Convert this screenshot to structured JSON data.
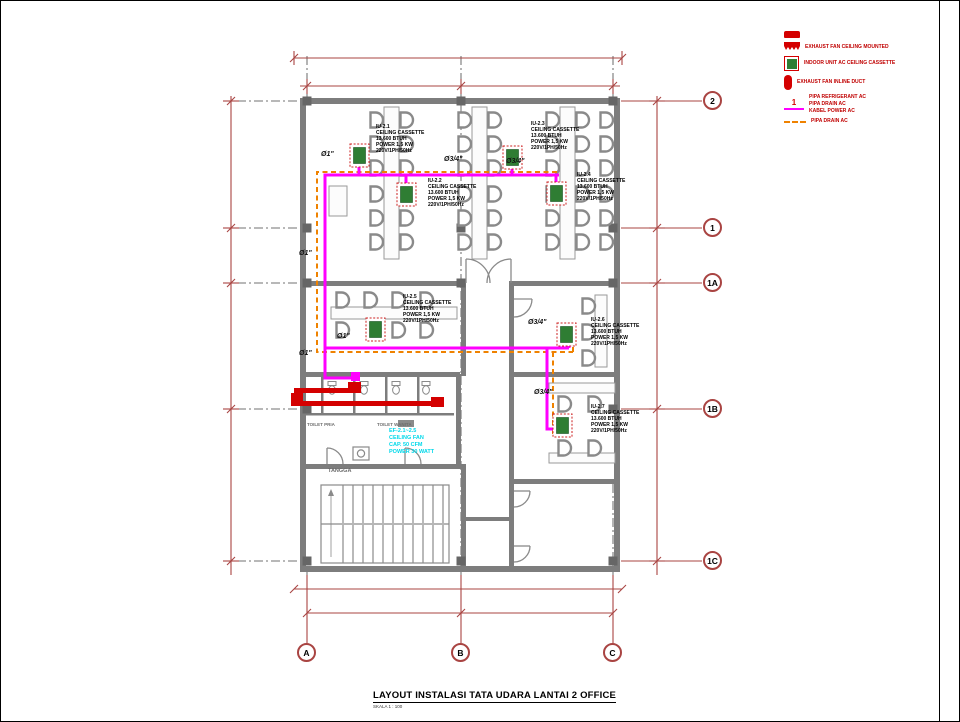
{
  "drawing_title": {
    "text": "LAYOUT INSTALASI TATA UDARA LANTAI 2 OFFICE",
    "scale": "SKALA 1 : 100"
  },
  "legend": {
    "items": [
      {
        "label": ""
      },
      {
        "label": "EXHAUST FAN CEILING MOUNTED"
      },
      {
        "label": "INDOOR UNIT AC CEILING CASSETTE"
      },
      {
        "label": "EXHAUST FAN INLINE DUCT"
      },
      {
        "label_lines": [
          "PIPA REFRIGERANT AC",
          "PIPA DRAIN AC",
          "KABEL POWER AC"
        ]
      },
      {
        "label": "PIPA DRAIN AC"
      }
    ]
  },
  "units": [
    {
      "tag": "IU-2.1",
      "type": "CEILING CASSETTE",
      "capacity": "13.600 BTUH",
      "power": "POWER 1,5 KW",
      "electrical": "220V/1PH/50Hz"
    },
    {
      "tag": "IU-2.2",
      "type": "CEILING CASSETTE",
      "capacity": "13.600 BTUH",
      "power": "POWER 1,5 KW",
      "electrical": "220V/1PH/50Hz"
    },
    {
      "tag": "IU-2.3",
      "type": "CEILING CASSETTE",
      "capacity": "13.600 BTUH",
      "power": "POWER 1,5 KW",
      "electrical": "220V/1PH/50Hz"
    },
    {
      "tag": "IU-2.4",
      "type": "CEILING CASSETTE",
      "capacity": "13.600 BTUH",
      "power": "POWER 1,5 KW",
      "electrical": "220V/1PH/50Hz"
    },
    {
      "tag": "IU-2.5",
      "type": "CEILING CASSETTE",
      "capacity": "13.600 BTUH",
      "power": "POWER 1,5 KW",
      "electrical": "220V/1PH/50Hz"
    },
    {
      "tag": "IU-2.6",
      "type": "CEILING CASSETTE",
      "capacity": "13.600 BTUH",
      "power": "POWER 1,5 KW",
      "electrical": "220V/1PH/50Hz"
    },
    {
      "tag": "IU-2.7",
      "type": "CEILING CASSETTE",
      "capacity": "13.600 BTUH",
      "power": "POWER 1,5 KW",
      "electrical": "220V/1PH/50Hz"
    }
  ],
  "exhaust_fan_label": {
    "tag": "EF-2.1~2.5",
    "type": "CEILING FAN",
    "capacity": "CAP. 50 CFM",
    "power": "POWER 30 WATT"
  },
  "grid_bubbles": {
    "right": [
      "2",
      "1",
      "1A",
      "1B",
      "1C"
    ],
    "bottom": [
      "A",
      "B",
      "C"
    ]
  },
  "room_labels": [
    "TOILET PRIA",
    "TOILET WANITA",
    "TANGGA"
  ],
  "pipe_sizes": {
    "one_inch": "Ø1\"",
    "three_quarter": "Ø3/4\""
  },
  "colors": {
    "refrigerant_pipe": "#FF00FF",
    "drain_pipe": "#EF8200",
    "exhaust_duct": "#D40000",
    "indoor_unit": "#2F7D33",
    "dimension": "#A94442",
    "wall": "#7D7D7D",
    "exhaust_fan_text": "#00D8EA",
    "legend_text": "#C00000"
  }
}
